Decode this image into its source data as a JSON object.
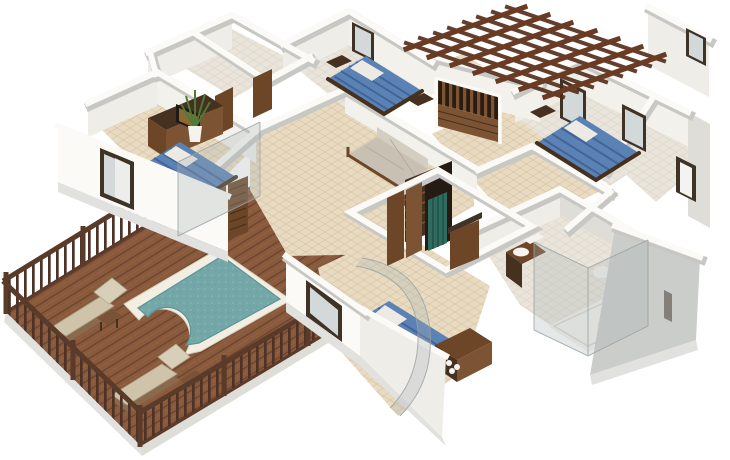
{
  "scene": {
    "description": "Isometric 3D render of a single-storey house floor plan, white walls and beige tiled floors, with four bedrooms with blue beds, living room with sofa, walk-in wardrobe, two bathrooms with glass showers, timber pergola over the entrance, and an outdoor timber deck with swimming pool, railing and two sun loungers",
    "width": 730,
    "height": 460,
    "view": "aerial-isometric",
    "background": "#ffffff"
  },
  "colors": {
    "wall_top": "#fbfaf7",
    "wall_face_light": "#efede8",
    "wall_face_warm": "#f3f1ec",
    "wall_face_mid": "#deddd8",
    "wall_face_dark": "#cbcdca",
    "wall_shade": "#c7c7c3",
    "plinth": "#e1e1df",
    "floor_tile": "#e8dbc2",
    "floor_pale": "#e9e5dc",
    "tile_line": "#b99a6b",
    "deck_wood": "#8a5a3d",
    "deck_plank": "#6d452f",
    "deck_plank_light": "#9a6a4a",
    "railing_wood": "#5a3a29",
    "baluster": "#4e3226",
    "pool_coping": "#f2eee2",
    "pool_coping_edge": "#d8d1bd",
    "pool_water": "#73a7a8",
    "pool_water_deep": "#5f9596",
    "lounge_cushion": "#cfc4aa",
    "lounge_cushion_light": "#d8cfb8",
    "lounge_frame": "#8a6a4c",
    "table_wood": "#7a5336",
    "bed_blue": "#5b82b4",
    "bed_blue_dark": "#3e6093",
    "linen_white": "#eceae3",
    "wood_dark": "#46301f",
    "wood_door": "#6d4527",
    "wood_mid": "#7c5434",
    "pergola_wood": "#6a3a22",
    "pergola_wood_dark": "#512a18",
    "sofa_fabric": "#c8c1b3",
    "sofa_fabric_light": "#d4cec2",
    "glass_tint": "#a9b2b4",
    "window_glass": "#d3d9d9",
    "frame_dark": "#3f3226",
    "plant_green": "#4d7a39",
    "clothes_teal": "#2f6b5e",
    "closet_dark": "#241b12",
    "tv_screen": "#8a6a33",
    "white_fixture": "#f4f3ef"
  },
  "house": {
    "rooms": [
      {
        "name": "bedroom-left",
        "furniture": [
          "blue-double-bed",
          "dresser-with-tv",
          "nightstand",
          "potted-plant",
          "window-wall"
        ]
      },
      {
        "name": "bedroom-top-middle",
        "furniture": [
          "blue-double-bed",
          "wall-mirror",
          "nightstands"
        ]
      },
      {
        "name": "bedroom-top-right",
        "furniture": [
          "blue-double-bed",
          "two-windows",
          "nightstand"
        ]
      },
      {
        "name": "bedroom-bottom-center",
        "furniture": [
          "blue-double-bed",
          "nightstand",
          "dresser-with-decor-balls",
          "curved-glass-wall",
          "window"
        ]
      },
      {
        "name": "living-room",
        "furniture": [
          "sofa",
          "coffee-table"
        ]
      },
      {
        "name": "walk-in-wardrobe",
        "furniture": [
          "slatted-wardrobe",
          "hanging-clothes",
          "louvre-doors"
        ]
      },
      {
        "name": "bathroom-main",
        "furniture": [
          "glass-shower",
          "shower-tray",
          "vanity-with-sink",
          "toilet",
          "towels"
        ]
      },
      {
        "name": "storerooms-top-left",
        "furniture": []
      },
      {
        "name": "dressing-room-right",
        "furniture": [
          "door-frame"
        ]
      },
      {
        "name": "entrance-porch",
        "furniture": [
          "timber-louvre-gate"
        ]
      }
    ],
    "bedroom_count": 4
  },
  "outdoor": {
    "deck": {
      "material": "timber-planks",
      "railing": "timber-balustrade-three-sides"
    },
    "pool": {
      "shape": "rectangle-with-rounded-lobe",
      "coping": "white-stone"
    },
    "loungers": 2,
    "side_tables": 2,
    "pergola": {
      "material": "timber-lattice",
      "location": "over-entrance"
    }
  }
}
